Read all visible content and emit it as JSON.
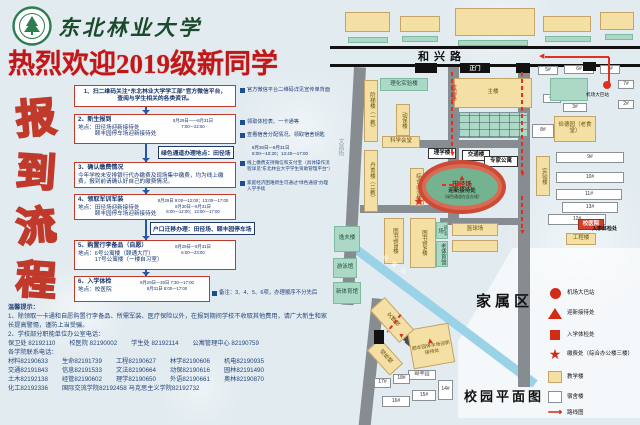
{
  "header": {
    "university": "东北林业大学",
    "title": "热烈欢迎2019级新同学"
  },
  "flow": {
    "vertical_title": "报到流程",
    "steps": [
      {
        "body": "1、扫二维码关注“东北林业大学学工部”官方微信平台，\n查阅与学生相关的各类资讯。",
        "center": true
      },
      {
        "heading": "2、新生报到",
        "body": "地点：田径场迎新接待处\n　　　颐丰园停车场迎新接待处",
        "time": "8月29日——8月31日\n7:00—22:00"
      },
      {
        "heading": "3、确认缴费情况",
        "body": "今年学校未安排银行代办缴费及现场集中缴费，均为线上缴费，报到前请确认好自己的缴费情况。"
      },
      {
        "heading": "4、领取军训军装",
        "body": "地点：田径场迎新接待处\n　　　颐丰园停车场迎新接待处",
        "time": "8月29日 9:00—12:00；13:00—17:00\n8月30日—8月31日\n8:00—12:00；13:00—17:00"
      },
      {
        "heading": "5、购置行李备品（自愿）",
        "body": "地点：6号公寓楼（颐通大厅）\n　　　17号公寓楼（一楼自习室）",
        "time": "8月29日—8月31日\n6:00—23:00"
      },
      {
        "heading": "6、入学体检",
        "body": "地点：校医院",
        "time": "8月29日—30日 7:30—17:00\n8月31日 8:00—17:00"
      }
    ],
    "notes": [
      {
        "x": 240,
        "y": 87,
        "w": 92,
        "s": 5.2,
        "text": "官方微信平台二维码详见宣传单背面"
      },
      {
        "x": 240,
        "y": 119,
        "w": 92,
        "s": 5.2,
        "text": "领取体检表、一卡通等"
      },
      {
        "x": 240,
        "y": 132,
        "w": 92,
        "s": 5.2,
        "text": "查看宿舍分配情况，领取宿舍钥匙"
      },
      {
        "x": 240,
        "y": 160,
        "w": 92,
        "s": 4.6,
        "text": "线上缴费支持微信和支付宝（具体操作流程详见“东北林业大学学生资助管理平台”）"
      },
      {
        "x": 240,
        "y": 180,
        "w": 92,
        "s": 4.6,
        "text": "家庭经济困难新生可通过“绿色通道”办理入学手续"
      },
      {
        "x": 212,
        "y": 290,
        "w": 120,
        "s": 5.4,
        "text": "备注：3、4、5、6项，办理顺序不分先后"
      }
    ],
    "inline_boxes": [
      {
        "x": 158,
        "y": 146,
        "text": "绿色通道办理地点：田径场",
        "extra": "8月30日—8月31日\n8:00—10:30；13:40—17:00",
        "ex": 252,
        "ey": 145
      },
      {
        "x": 150,
        "y": 222,
        "text": "户口迁移办理：田径场、颐丰园停车场",
        "extra": "",
        "ex": 0,
        "ey": 0
      }
    ]
  },
  "tips": {
    "title": "温馨提示：",
    "items": [
      "1、除领取一卡通和自愿购置行李备品、所需军装、医疗保险以外，在报到期间学校不收取其他费用，请广大新生和家长提高警惕，谨防上当受骗。",
      "2、学校部分职能单位办公室电话："
    ],
    "dept_phones": [
      [
        "保卫处",
        "82192110"
      ],
      [
        "校医院",
        "82190002"
      ],
      [
        "学生处",
        "82192114"
      ],
      [
        "公寓管理中心",
        "82190759"
      ]
    ],
    "college_title": "各学院联系电话：",
    "college_phones": [
      [
        "材料",
        "82190633"
      ],
      [
        "生命",
        "82191739"
      ],
      [
        "工程",
        "82190627"
      ],
      [
        "林学",
        "82190606"
      ],
      [
        "机电",
        "82190935"
      ],
      [
        "交通",
        "82191843"
      ],
      [
        "信息",
        "82191533"
      ],
      [
        "文法",
        "82190664"
      ],
      [
        "动保",
        "82190616"
      ],
      [
        "园林",
        "82191490"
      ],
      [
        "土木",
        "82192138"
      ],
      [
        "经管",
        "82190602"
      ],
      [
        "理学",
        "82190650"
      ],
      [
        "外语",
        "82190661"
      ],
      [
        "奥林",
        "82190870"
      ],
      [
        "化工",
        "82192336"
      ],
      [
        "国际交流学院",
        "82192458"
      ],
      [
        "马克思主义学院",
        "82192732"
      ]
    ]
  },
  "map": {
    "roads": [
      {
        "x": 0,
        "y": 46,
        "w": 310,
        "h": 3,
        "c": "#111111"
      },
      {
        "x": 0,
        "y": 64,
        "w": 310,
        "h": 3,
        "c": "#111111"
      },
      {
        "x": 118,
        "y": 67,
        "w": 11,
        "h": 155
      },
      {
        "x": 188,
        "y": 67,
        "w": 12,
        "h": 320
      },
      {
        "x": 24,
        "y": 67,
        "w": 12,
        "h": 238,
        "r": 3
      },
      {
        "x": 42,
        "y": 298,
        "w": 12,
        "h": 128,
        "r": 6
      },
      {
        "x": 64,
        "y": 140,
        "w": 128,
        "h": 8
      },
      {
        "x": 30,
        "y": 205,
        "w": 90,
        "h": 8
      },
      {
        "x": 110,
        "y": 218,
        "w": 80,
        "h": 7
      },
      {
        "x": 70,
        "y": 328,
        "w": 16,
        "h": 7,
        "r": 40,
        "c": "#4a4f54"
      },
      {
        "x": 79,
        "y": 337,
        "w": 16,
        "h": 7,
        "r": 40,
        "c": "#4a4f54"
      }
    ],
    "river": {
      "x": 16,
      "y": 236,
      "w": 240,
      "h": 9,
      "r": 37,
      "name": "马家沟"
    },
    "family_zone": {
      "x": 128,
      "y": 248,
      "w": 182,
      "h": 170
    },
    "buildings": [
      {
        "t": "",
        "x": 15,
        "y": 12,
        "w": 45,
        "h": 20,
        "k": "teach"
      },
      {
        "t": "",
        "x": 70,
        "y": 16,
        "w": 40,
        "h": 16,
        "k": "teach"
      },
      {
        "t": "",
        "x": 125,
        "y": 8,
        "w": 80,
        "h": 28,
        "k": "teach"
      },
      {
        "t": "",
        "x": 213,
        "y": 16,
        "w": 48,
        "h": 16,
        "k": "teach"
      },
      {
        "t": "",
        "x": 270,
        "y": 12,
        "w": 34,
        "h": 18,
        "k": "teach"
      },
      {
        "t": "",
        "x": 18,
        "y": 37,
        "w": 40,
        "h": 6,
        "k": "service"
      },
      {
        "t": "",
        "x": 72,
        "y": 36,
        "w": 36,
        "h": 6,
        "k": "service"
      },
      {
        "t": "",
        "x": 128,
        "y": 40,
        "w": 70,
        "h": 6,
        "k": "service"
      },
      {
        "t": "",
        "x": 215,
        "y": 36,
        "w": 46,
        "h": 6,
        "k": "service"
      },
      {
        "t": "",
        "x": 275,
        "y": 34,
        "w": 28,
        "h": 6,
        "k": "service"
      },
      {
        "t": "理化实验楼",
        "x": 50,
        "y": 78,
        "w": 48,
        "h": 13,
        "k": "service"
      },
      {
        "t": "阶梯楼（一教）",
        "x": 34,
        "y": 80,
        "w": 14,
        "h": 62,
        "k": "teach",
        "v": 1
      },
      {
        "t": "动保楼",
        "x": 66,
        "y": 104,
        "w": 14,
        "h": 32,
        "k": "teach",
        "v": 1
      },
      {
        "t": "主楼",
        "x": 124,
        "y": 78,
        "w": 78,
        "h": 30,
        "k": "teach"
      },
      {
        "t": "",
        "x": 128,
        "y": 112,
        "w": 70,
        "h": 26,
        "k": "grid"
      },
      {
        "t": "科学会堂",
        "x": 52,
        "y": 136,
        "w": 38,
        "h": 12,
        "k": "teach"
      },
      {
        "t": "丹青楼（二教）",
        "x": 34,
        "y": 150,
        "w": 14,
        "h": 62,
        "k": "teach",
        "v": 1
      },
      {
        "t": "理学楼",
        "x": 98,
        "y": 148,
        "w": 28,
        "h": 11,
        "k": "labelbox"
      },
      {
        "t": "交通楼",
        "x": 132,
        "y": 150,
        "w": 28,
        "h": 11,
        "k": "labelbox"
      },
      {
        "t": "专家公寓",
        "x": 154,
        "y": 156,
        "w": 34,
        "h": 11,
        "k": "labelbox"
      },
      {
        "t": "综合办公楼",
        "x": 80,
        "y": 168,
        "w": 14,
        "h": 38,
        "k": "teach",
        "v": 1
      },
      {
        "t": "图书馆B楼",
        "x": 54,
        "y": 218,
        "w": 20,
        "h": 46,
        "k": "teach",
        "v": 1
      },
      {
        "t": "图书馆A楼",
        "x": 80,
        "y": 218,
        "w": 26,
        "h": 50,
        "k": "teach",
        "v": 1
      },
      {
        "t": "逸夫楼",
        "x": 4,
        "y": 226,
        "w": 26,
        "h": 26,
        "k": "service"
      },
      {
        "t": "游泳馆",
        "x": 3,
        "y": 258,
        "w": 24,
        "h": 20,
        "k": "service"
      },
      {
        "t": "新体育馆",
        "x": 3,
        "y": 282,
        "w": 28,
        "h": 22,
        "k": "service"
      },
      {
        "t": "网球场",
        "x": 106,
        "y": 222,
        "w": 12,
        "h": 17,
        "k": "service",
        "v": 1
      },
      {
        "t": "老体育馆",
        "x": 106,
        "y": 241,
        "w": 12,
        "h": 26,
        "k": "service",
        "v": 1
      },
      {
        "t": "篮球场",
        "x": 122,
        "y": 223,
        "w": 46,
        "h": 13,
        "k": "teach"
      },
      {
        "t": "",
        "x": 122,
        "y": 240,
        "w": 46,
        "h": 12,
        "k": "teach"
      },
      {
        "t": "俭德园（老食堂）",
        "x": 224,
        "y": 116,
        "w": 42,
        "h": 26,
        "k": "teach"
      },
      {
        "t": "实验楼",
        "x": 206,
        "y": 156,
        "w": 14,
        "h": 40,
        "k": "teach",
        "v": 1
      },
      {
        "t": "8#",
        "x": 202,
        "y": 124,
        "w": 22,
        "h": 14,
        "k": "dorm"
      },
      {
        "t": "9#",
        "x": 226,
        "y": 152,
        "w": 68,
        "h": 11,
        "k": "dorm"
      },
      {
        "t": "10#",
        "x": 226,
        "y": 172,
        "w": 68,
        "h": 11,
        "k": "dorm"
      },
      {
        "t": "11#",
        "x": 226,
        "y": 189,
        "w": 66,
        "h": 11,
        "k": "dorm"
      },
      {
        "t": "13#",
        "x": 232,
        "y": 202,
        "w": 56,
        "h": 11,
        "k": "dorm"
      },
      {
        "t": "12#",
        "x": 218,
        "y": 214,
        "w": 58,
        "h": 11,
        "k": "dorm"
      },
      {
        "t": "校医院",
        "x": 248,
        "y": 219,
        "w": 26,
        "h": 11,
        "k": "red"
      },
      {
        "t": "工程楼",
        "x": 236,
        "y": 233,
        "w": 30,
        "h": 12,
        "k": "teach"
      },
      {
        "t": "5#",
        "x": 208,
        "y": 66,
        "w": 20,
        "h": 9,
        "k": "dorm"
      },
      {
        "t": "6#",
        "x": 234,
        "y": 65,
        "w": 30,
        "h": 9,
        "k": "dorm"
      },
      {
        "t": "1#",
        "x": 270,
        "y": 65,
        "w": 20,
        "h": 9,
        "k": "dorm"
      },
      {
        "t": "7#",
        "x": 288,
        "y": 80,
        "w": 16,
        "h": 9,
        "k": "dorm"
      },
      {
        "t": "2#",
        "x": 288,
        "y": 100,
        "w": 16,
        "h": 9,
        "k": "dorm"
      },
      {
        "t": "4#",
        "x": 213,
        "y": 94,
        "w": 18,
        "h": 9,
        "k": "dorm"
      },
      {
        "t": "3#",
        "x": 233,
        "y": 103,
        "w": 24,
        "h": 9,
        "k": "dorm"
      },
      {
        "t": "",
        "x": 220,
        "y": 78,
        "w": 38,
        "h": 23,
        "k": "service"
      },
      {
        "t": "颐丰园停车场迎新接待处",
        "x": 80,
        "y": 326,
        "w": 42,
        "h": 40,
        "k": "teach",
        "r": -10,
        "tri": 1
      },
      {
        "t": "颐丰园",
        "x": 78,
        "y": 370,
        "w": 28,
        "h": 10,
        "k": "dorm"
      },
      {
        "t": "15#",
        "x": 82,
        "y": 390,
        "w": 24,
        "h": 11,
        "k": "dorm"
      },
      {
        "t": "14#",
        "x": 108,
        "y": 380,
        "w": 15,
        "h": 20,
        "k": "dorm"
      },
      {
        "t": "16#",
        "x": 52,
        "y": 396,
        "w": 28,
        "h": 11,
        "k": "dorm"
      },
      {
        "t": "17#",
        "x": 44,
        "y": 378,
        "w": 17,
        "h": 10,
        "k": "dorm"
      },
      {
        "t": "18#",
        "x": 63,
        "y": 374,
        "w": 17,
        "h": 10,
        "k": "dorm"
      },
      {
        "t": "文博楼",
        "x": 52,
        "y": 298,
        "w": 20,
        "h": 44,
        "k": "teach",
        "v": 1,
        "r": -42
      },
      {
        "t": "成栋楼",
        "x": 46,
        "y": 340,
        "w": 18,
        "h": 34,
        "k": "teach",
        "v": 1,
        "r": -42
      }
    ],
    "gates": [
      {
        "t": "",
        "x": 85,
        "y": 63,
        "w": 22,
        "h": 10
      },
      {
        "t": "正门",
        "x": 130,
        "y": 63,
        "w": 30,
        "h": 10
      },
      {
        "t": "",
        "x": 186,
        "y": 63,
        "w": 14,
        "h": 10
      },
      {
        "t": "",
        "x": 253,
        "y": 62,
        "w": 13,
        "h": 9
      },
      {
        "t": "",
        "x": 44,
        "y": 330,
        "w": 10,
        "h": 14
      }
    ],
    "track": {
      "x": 88,
      "y": 160,
      "w": 88,
      "h": 54,
      "t1": "田径场",
      "t2": "迎新接待处",
      "t3": "（绿色通道在此办理）"
    },
    "routes": [
      {
        "x": 215,
        "y": 56,
        "w": 64,
        "h": 2,
        "a": "left"
      },
      {
        "x": 278,
        "y": 57,
        "w": 2,
        "h": 26
      },
      {
        "x": 191,
        "y": 72,
        "w": 2,
        "h": 102,
        "d": 1,
        "a": "down"
      },
      {
        "x": 121,
        "y": 72,
        "w": 2,
        "h": 82,
        "d": 1,
        "a": "down"
      },
      {
        "x": 112,
        "y": 184,
        "w": 16,
        "h": 2,
        "d": 1,
        "a": "right"
      },
      {
        "x": 191,
        "y": 196,
        "w": 2,
        "h": 36,
        "d": 1,
        "a": "down"
      },
      {
        "x": 70,
        "y": 314,
        "w": 2,
        "h": 22,
        "d": 1,
        "a": "down",
        "r": 38
      }
    ],
    "markers": {
      "bus_dot": {
        "x": 273,
        "y": 81
      },
      "pay_star": {
        "x": 84,
        "y": 197
      }
    },
    "labels": [
      {
        "t": "和兴路",
        "x": 88,
        "y": 48,
        "s": 11,
        "b": 1,
        "ls": 5
      },
      {
        "t": "文昌街",
        "x": 6,
        "y": 138,
        "s": 6,
        "v": 1,
        "c": "#8fa3b2"
      },
      {
        "t": "校园路",
        "x": 119,
        "y": 84,
        "s": 5.5,
        "v": 1,
        "c": "#c03028"
      },
      {
        "t": "马家沟",
        "x": 56,
        "y": 252,
        "s": 6,
        "c": "#ffffff",
        "r": 37,
        "ls": 5
      },
      {
        "t": "家属区",
        "x": 146,
        "y": 290,
        "s": 15,
        "b": 1,
        "ls": 4
      },
      {
        "t": "校园平面图",
        "x": 134,
        "y": 386,
        "s": 13,
        "b": 1,
        "ls": 3
      },
      {
        "t": "机场大巴站",
        "x": 256,
        "y": 92,
        "s": 4.6
      },
      {
        "t": "入学体检处",
        "x": 262,
        "y": 225,
        "s": 5,
        "b": 1
      }
    ],
    "legend": [
      {
        "i": "circle",
        "t": "机场大巴站",
        "y": 288
      },
      {
        "i": "triangle",
        "t": "迎新接待处",
        "y": 308
      },
      {
        "i": "square",
        "t": "入学体检处",
        "y": 330
      },
      {
        "i": "star",
        "t": "缴费处（综合办公楼三楼）",
        "y": 348
      },
      {
        "i": "teach",
        "t": "教学楼",
        "y": 371
      },
      {
        "i": "dorm",
        "t": "宿舍楼",
        "y": 391
      },
      {
        "i": "route",
        "t": "路线图",
        "y": 408
      }
    ]
  }
}
